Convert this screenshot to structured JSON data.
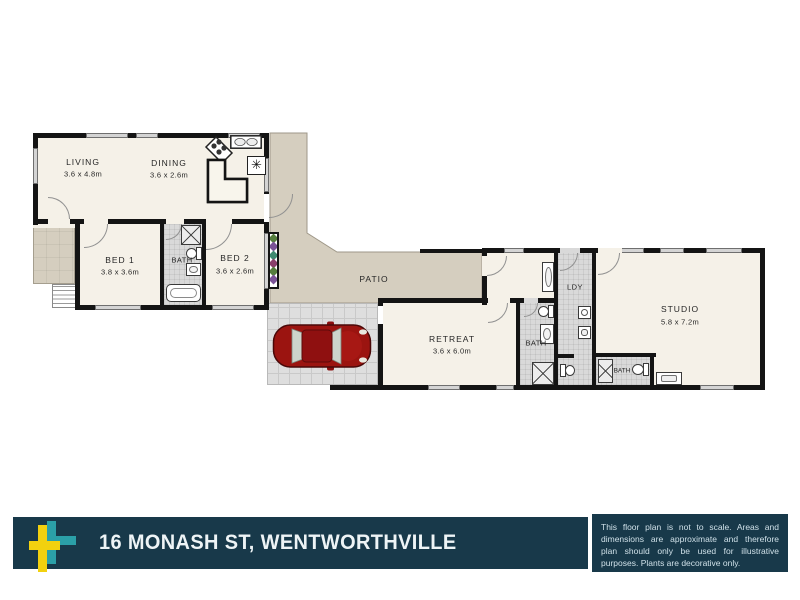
{
  "floorplan": {
    "rooms": {
      "living": {
        "name": "LIVING",
        "dims": "3.6 x 4.8m"
      },
      "dining": {
        "name": "DINING",
        "dims": "3.6 x 2.6m"
      },
      "bed1": {
        "name": "BED 1",
        "dims": "3.8 x 3.6m"
      },
      "bath_main": {
        "name": "BATH"
      },
      "bed2": {
        "name": "BED 2",
        "dims": "3.6 x 2.6m"
      },
      "patio": {
        "name": "PATIO"
      },
      "retreat": {
        "name": "RETREAT",
        "dims": "3.6 x 6.0m"
      },
      "bath_rear": {
        "name": "BATH"
      },
      "laundry": {
        "name": "LDY"
      },
      "studio": {
        "name": "STUDIO",
        "dims": "5.8 x 7.2m"
      },
      "bath_studio": {
        "name": "BATH"
      }
    },
    "symbols": {
      "appliance_asterisk": "✳"
    },
    "colors": {
      "wall": "#141414",
      "floor": "#f5f1e8",
      "patio_deck": "#d5cebf",
      "wet_area_floor": "#d9d9d9",
      "carport": "#dedede",
      "car_red": "#9b1410",
      "plant_green": "#557d3d",
      "plant_purple": "#7a5296"
    }
  },
  "banner": {
    "address": "16 MONASH ST, WENTWORTHVILLE",
    "disclaimer": "This floor plan is not to scale. Areas and dimensions are approximate and therefore plan should only be used for illustrative purposes. Plants are decorative only.",
    "colors": {
      "bar": "#18394a",
      "logo_yellow": "#f2d10f",
      "logo_teal": "#2ba0a8",
      "text": "#eef4f6"
    }
  }
}
